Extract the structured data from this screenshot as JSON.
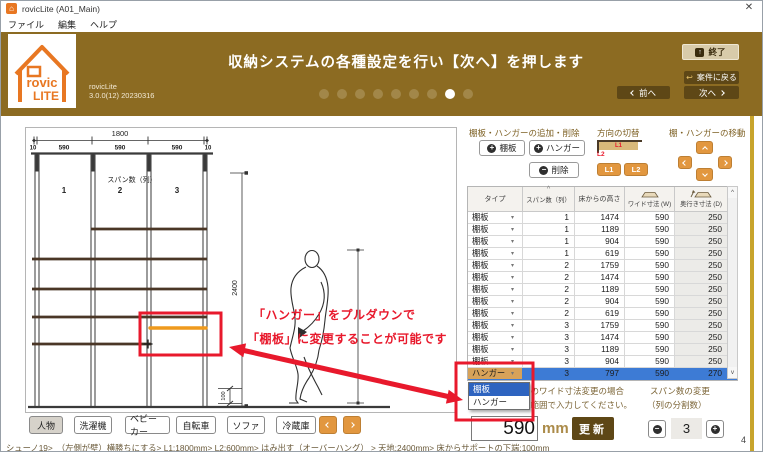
{
  "window": {
    "title": "rovicLite (A01_Main)",
    "close": "✕"
  },
  "menu": {
    "items": [
      "ファイル",
      "編集",
      "ヘルプ"
    ]
  },
  "header": {
    "logo_text1": "rovic",
    "logo_text2": "LITE",
    "app_name": "rovicLite",
    "app_version": "3.0.0(12) 20230316",
    "instruction": "収納システムの各種設定を行い【次へ】を押します",
    "progress": {
      "count": 9,
      "active_index": 7
    },
    "buttons": {
      "exit": "終了",
      "back_to_case": "案件に戻る",
      "prev": "前へ",
      "next": "次へ"
    }
  },
  "drawing": {
    "total_width_label": "1800",
    "segment_labels": [
      "10",
      "590",
      "590",
      "590",
      "10"
    ],
    "span_title": "スパン数（列）",
    "span_numbers": [
      "1",
      "2",
      "3"
    ],
    "height_label": "2400",
    "support_bottom_label": "100"
  },
  "annotation": {
    "line1": "「ハンガー」をプルダウンで",
    "line2": "「棚板」に変更することが可能です"
  },
  "panel": {
    "add_remove_title": "棚板・ハンガーの追加・削除",
    "add_shelf": "棚板",
    "add_hanger": "ハンガー",
    "delete": "削除",
    "direction_title": "方向の切替",
    "l1": "L1",
    "l2": "L2",
    "move_title": "棚・ハンガーの移動"
  },
  "table": {
    "headers": {
      "type": "タイプ",
      "span": "スパン数（列）",
      "height": "床からの高さ",
      "width": "ワイド寸法 (W)",
      "depth": "奥行き寸法 (D)"
    },
    "rows": [
      {
        "type": "棚板",
        "span": "1",
        "height": "1474",
        "width": "590",
        "depth": "250"
      },
      {
        "type": "棚板",
        "span": "1",
        "height": "1189",
        "width": "590",
        "depth": "250"
      },
      {
        "type": "棚板",
        "span": "1",
        "height": "904",
        "width": "590",
        "depth": "250"
      },
      {
        "type": "棚板",
        "span": "1",
        "height": "619",
        "width": "590",
        "depth": "250"
      },
      {
        "type": "棚板",
        "span": "2",
        "height": "1759",
        "width": "590",
        "depth": "250"
      },
      {
        "type": "棚板",
        "span": "2",
        "height": "1474",
        "width": "590",
        "depth": "250"
      },
      {
        "type": "棚板",
        "span": "2",
        "height": "1189",
        "width": "590",
        "depth": "250"
      },
      {
        "type": "棚板",
        "span": "2",
        "height": "904",
        "width": "590",
        "depth": "250"
      },
      {
        "type": "棚板",
        "span": "2",
        "height": "619",
        "width": "590",
        "depth": "250"
      },
      {
        "type": "棚板",
        "span": "3",
        "height": "1759",
        "width": "590",
        "depth": "250"
      },
      {
        "type": "棚板",
        "span": "3",
        "height": "1474",
        "width": "590",
        "depth": "250"
      },
      {
        "type": "棚板",
        "span": "3",
        "height": "1189",
        "width": "590",
        "depth": "250"
      },
      {
        "type": "棚板",
        "span": "3",
        "height": "904",
        "width": "590",
        "depth": "250"
      },
      {
        "type": "ハンガー",
        "span": "3",
        "height": "797",
        "width": "590",
        "depth": "270"
      }
    ],
    "selected_index": 13,
    "dropdown_options": [
      "棚板",
      "ハンガー"
    ],
    "dropdown_highlight_index": 0,
    "sort_indicator": "^",
    "scroll_up": "^",
    "scroll_down": "v"
  },
  "notes": {
    "width_note1": "棚板・ハンガーのワイド寸法変更の場合",
    "width_note2": "100～590mmの範囲で入力してください。",
    "span_note1": "スパン数の変更",
    "span_note2": "（列の分割数）"
  },
  "controls": {
    "width_value": "590",
    "unit": "mm",
    "update": "更新",
    "span_count": "3",
    "page": "4"
  },
  "objects": {
    "items": [
      "人物",
      "洗濯機",
      "ベビーカー",
      "自転車",
      "ソファ",
      "冷蔵庫"
    ],
    "selected_index": 0
  },
  "status": {
    "text": "シューノ19>　（左側が壁）横勝ちにする> L1:1800mm> L2:600mm> はみ出す（オーバーハング） > 天地:2400mm> 床からサポートの下端:100mm"
  },
  "icons": {
    "plus": "+",
    "minus": "−",
    "combo_arrow": "▾",
    "exit_glyph": "↑",
    "return_glyph": "↩",
    "home_glyph": "⌂"
  },
  "colors": {
    "header_brown": "#8c6b22",
    "dark_button": "#5e4716",
    "orange": "#e2973f",
    "red": "#e8192c",
    "selection_blue": "#3d7bd5",
    "logo_orange": "#e87722",
    "gold_strip": "#c8a42c"
  }
}
